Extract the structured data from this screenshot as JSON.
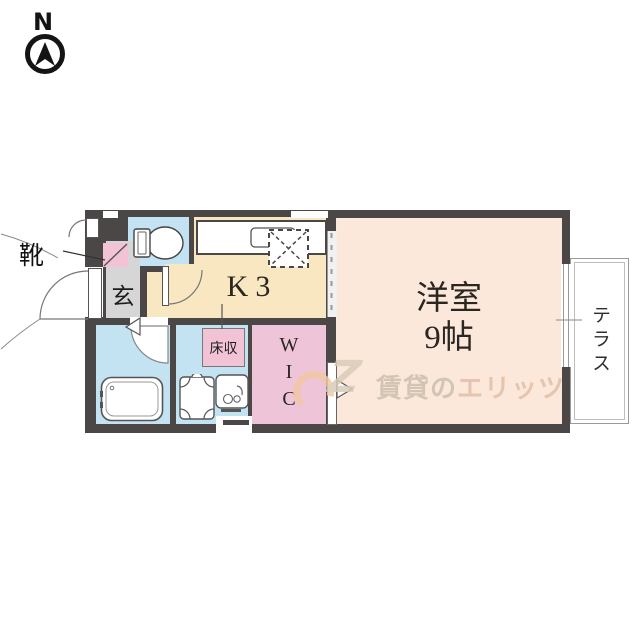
{
  "compass": {
    "north_label": "N"
  },
  "plan": {
    "shoes_label": "靴",
    "entrance_label": "玄",
    "kitchen_label": "K3",
    "main_room_label_line1": "洋室",
    "main_room_label_line2": "9帖",
    "wic_letters": [
      "W",
      "I",
      "C"
    ],
    "terrace_label": "テラス",
    "floor_storage_label": "床収"
  },
  "watermark": {
    "logo_letter": "Z",
    "text_left": "賃貸の",
    "text_right": "エリッツ"
  },
  "colors": {
    "wall": "#4b4747",
    "kitchen_floor": "#f8e7c1",
    "main_room_floor": "#fce8da",
    "wet_area_floor": "#c3e2f2",
    "closet_pink": "#eec4d8",
    "entrance_gray": "#d6d6d6",
    "watermark_tan": "#ccbfad",
    "watermark_orange": "#f1c8a6"
  }
}
